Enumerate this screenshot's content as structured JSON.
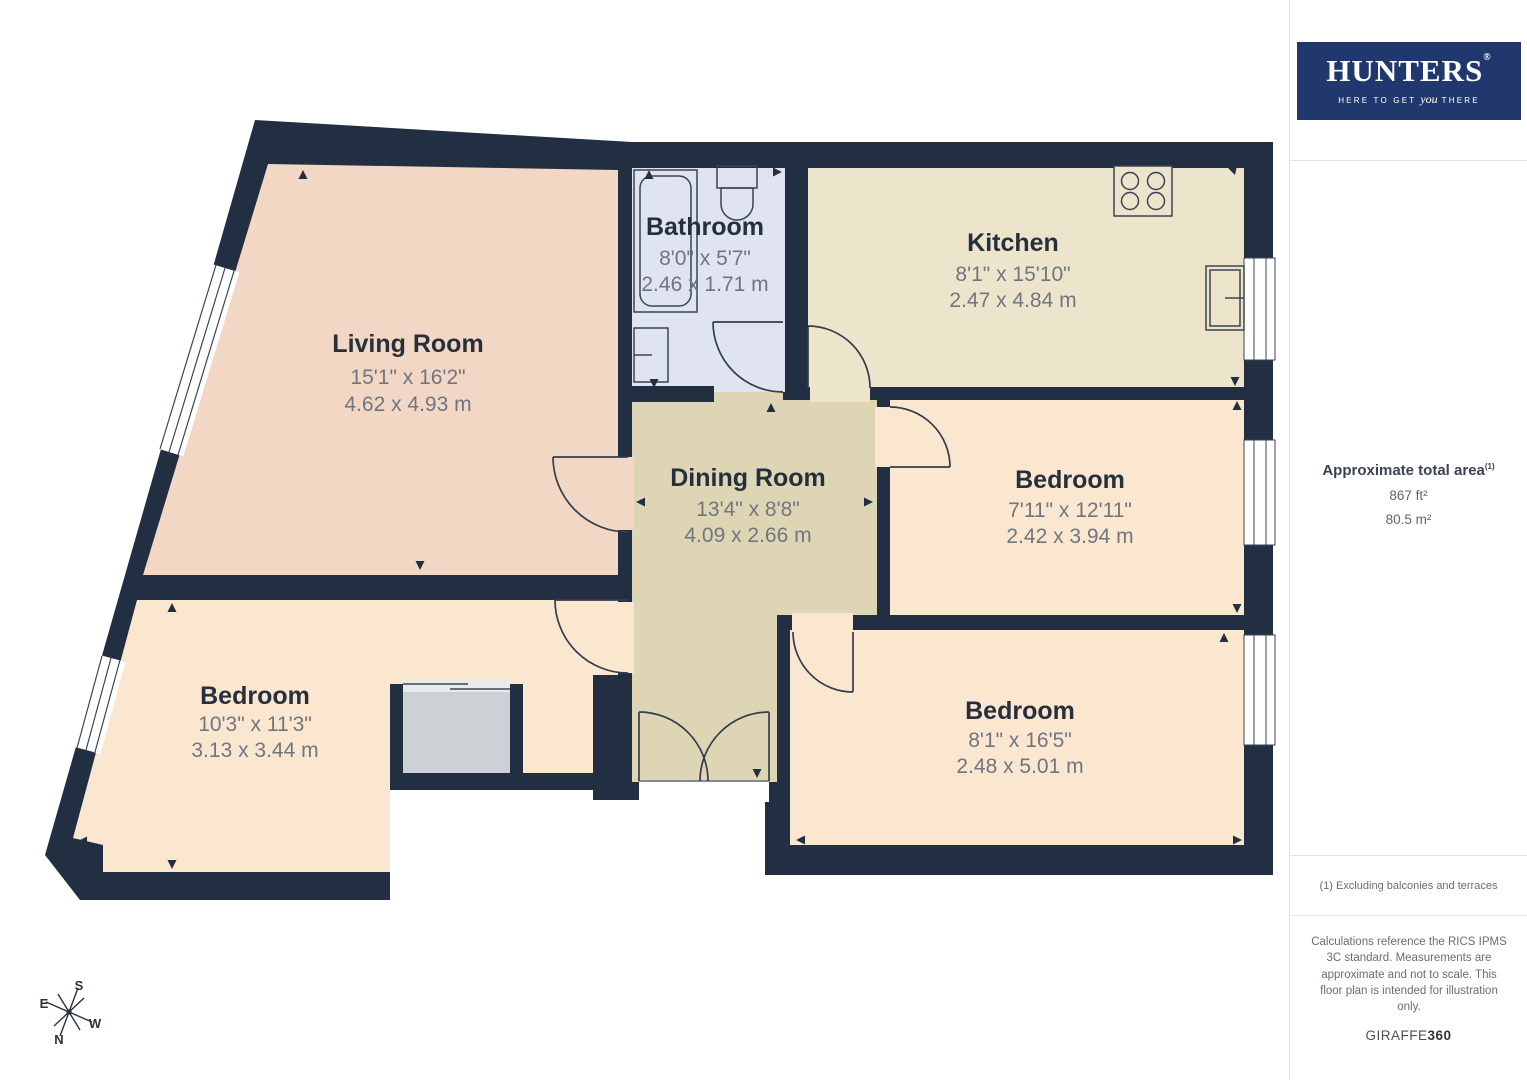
{
  "branding": {
    "logo_text": "HUNTERS",
    "logo_registered": "®",
    "tagline_pre": "HERE TO GET",
    "tagline_italic": "you",
    "tagline_post": "THERE",
    "logo_bg_color": "#21386e"
  },
  "sidebar": {
    "area_title": "Approximate total area",
    "area_title_sup": "(1)",
    "area_ft": "867 ft²",
    "area_m": "80.5 m²",
    "footnote": "(1) Excluding balconies and terraces",
    "disclaimer": "Calculations reference the RICS IPMS 3C standard. Measurements are approximate and not to scale. This floor plan is intended for illustration only.",
    "credit_left": "GIRAFFE",
    "credit_right": "360"
  },
  "rooms": [
    {
      "name": "Living Room",
      "imperial": "15'1\" x 16'2\"",
      "metric": "4.62 x 4.93 m"
    },
    {
      "name": "Bathroom",
      "imperial": "8'0\" x 5'7\"",
      "metric": "2.46 x 1.71 m"
    },
    {
      "name": "Kitchen",
      "imperial": "8'1\" x 15'10\"",
      "metric": "2.47 x 4.84 m"
    },
    {
      "name": "Dining Room",
      "imperial": "13'4\" x 8'8\"",
      "metric": "4.09 x 2.66 m"
    },
    {
      "name": "Bedroom",
      "imperial": "7'11\" x 12'11\"",
      "metric": "2.42 x 3.94 m"
    },
    {
      "name": "Bedroom",
      "imperial": "10'3\" x 11'3\"",
      "metric": "3.13 x 3.44 m"
    },
    {
      "name": "Bedroom",
      "imperial": "8'1\" x 16'5\"",
      "metric": "2.48 x 5.01 m"
    }
  ],
  "compass": {
    "n": "N",
    "s": "S",
    "e": "E",
    "w": "W"
  },
  "colors": {
    "wall": "#222f42",
    "living_room": "#f3d7c5",
    "bathroom": "#dfe4f0",
    "kitchen": "#ece5cc",
    "dining_hall": "#ded5b4",
    "bedroom": "#fbe7d0",
    "closet": "#cdd0d4",
    "room_title_text": "#262f3d",
    "dimension_text": "#6f7680"
  }
}
